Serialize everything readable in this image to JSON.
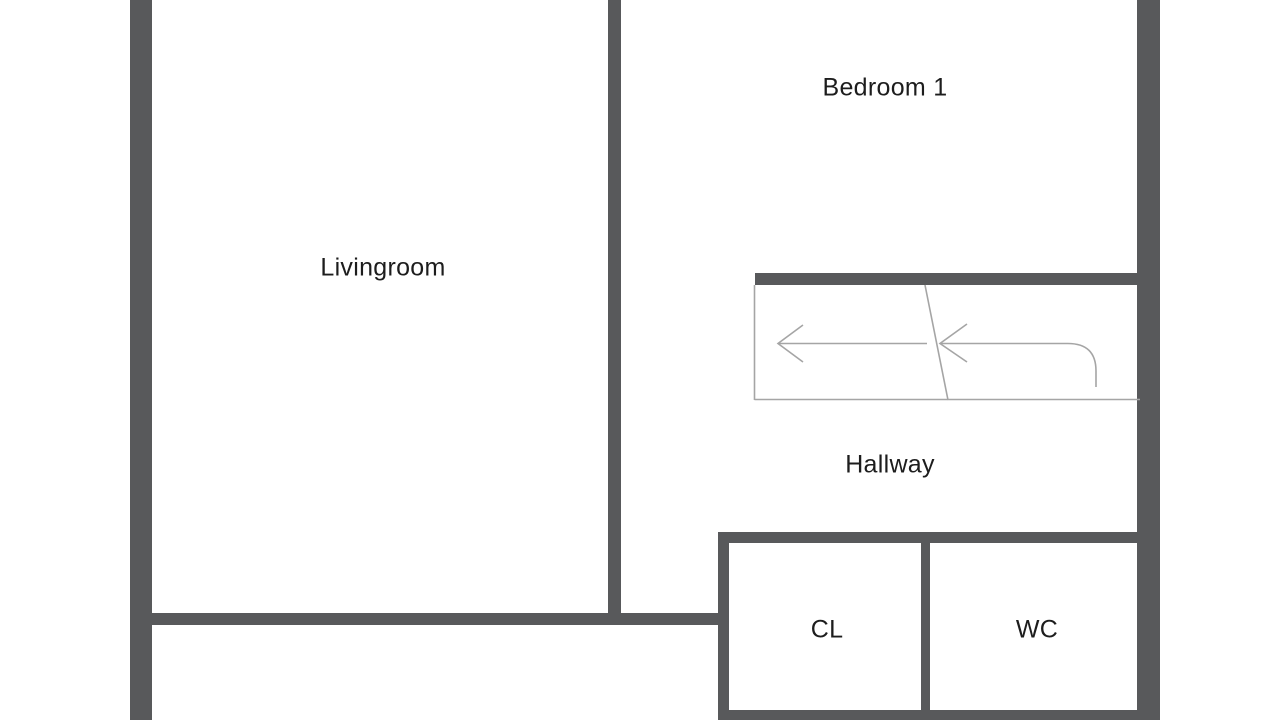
{
  "rooms": {
    "livingroom": {
      "label": "Livingroom"
    },
    "bedroom1": {
      "label": "Bedroom 1"
    },
    "hallway": {
      "label": "Hallway"
    },
    "closet": {
      "label": "CL"
    },
    "wc": {
      "label": "WC"
    }
  },
  "stairs": {
    "icon": "stair-direction-arrows-left"
  },
  "colors": {
    "wall": "#58595b",
    "stair_line": "#a5a5a5",
    "text": "#1d1d1d",
    "background": "#ffffff"
  }
}
